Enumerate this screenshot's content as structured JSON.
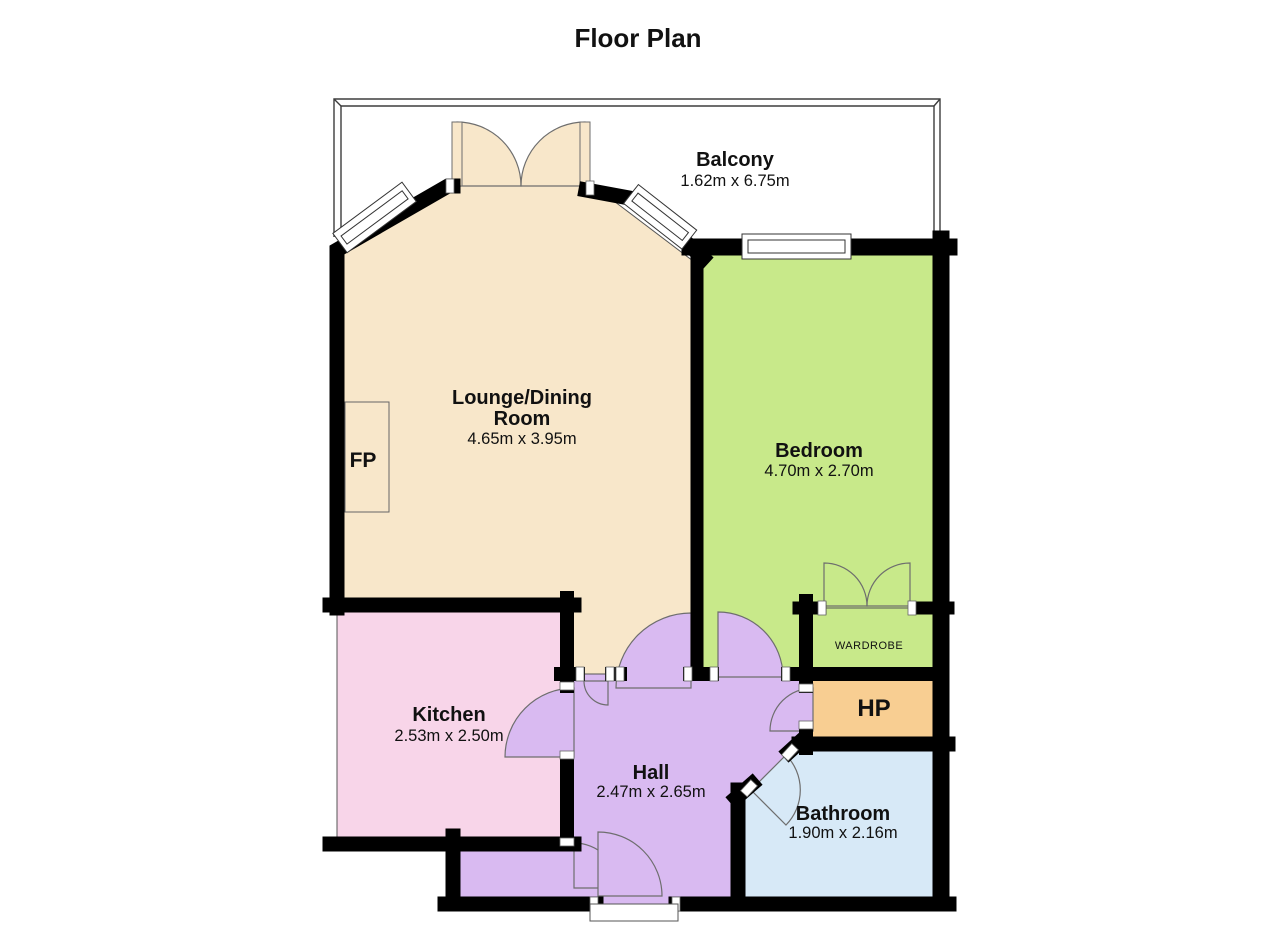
{
  "title": "Floor Plan",
  "colors": {
    "lounge": "#f8e7ca",
    "bedroom": "#c8e98a",
    "wardrobe": "#c8e98a",
    "kitchen": "#f8d5e9",
    "hall": "#d9baf1",
    "bathroom": "#d7e9f7",
    "hp": "#f8ce92",
    "wall": "#000000",
    "window": "#ffffff"
  },
  "rooms": {
    "balcony": {
      "name": "Balcony",
      "dims": "1.62m x 6.75m"
    },
    "lounge": {
      "name_line1": "Lounge/Dining",
      "name_line2": "Room",
      "dims": "4.65m x 3.95m"
    },
    "bedroom": {
      "name": "Bedroom",
      "dims": "4.70m x 2.70m"
    },
    "kitchen": {
      "name": "Kitchen",
      "dims": "2.53m x 2.50m"
    },
    "hall": {
      "name": "Hall",
      "dims": "2.47m x 2.65m"
    },
    "bathroom": {
      "name": "Bathroom",
      "dims": "1.90m x 2.16m"
    },
    "wardrobe": {
      "name": "WARDROBE"
    },
    "hp": {
      "name": "HP"
    },
    "fireplace": {
      "name": "FP"
    }
  }
}
